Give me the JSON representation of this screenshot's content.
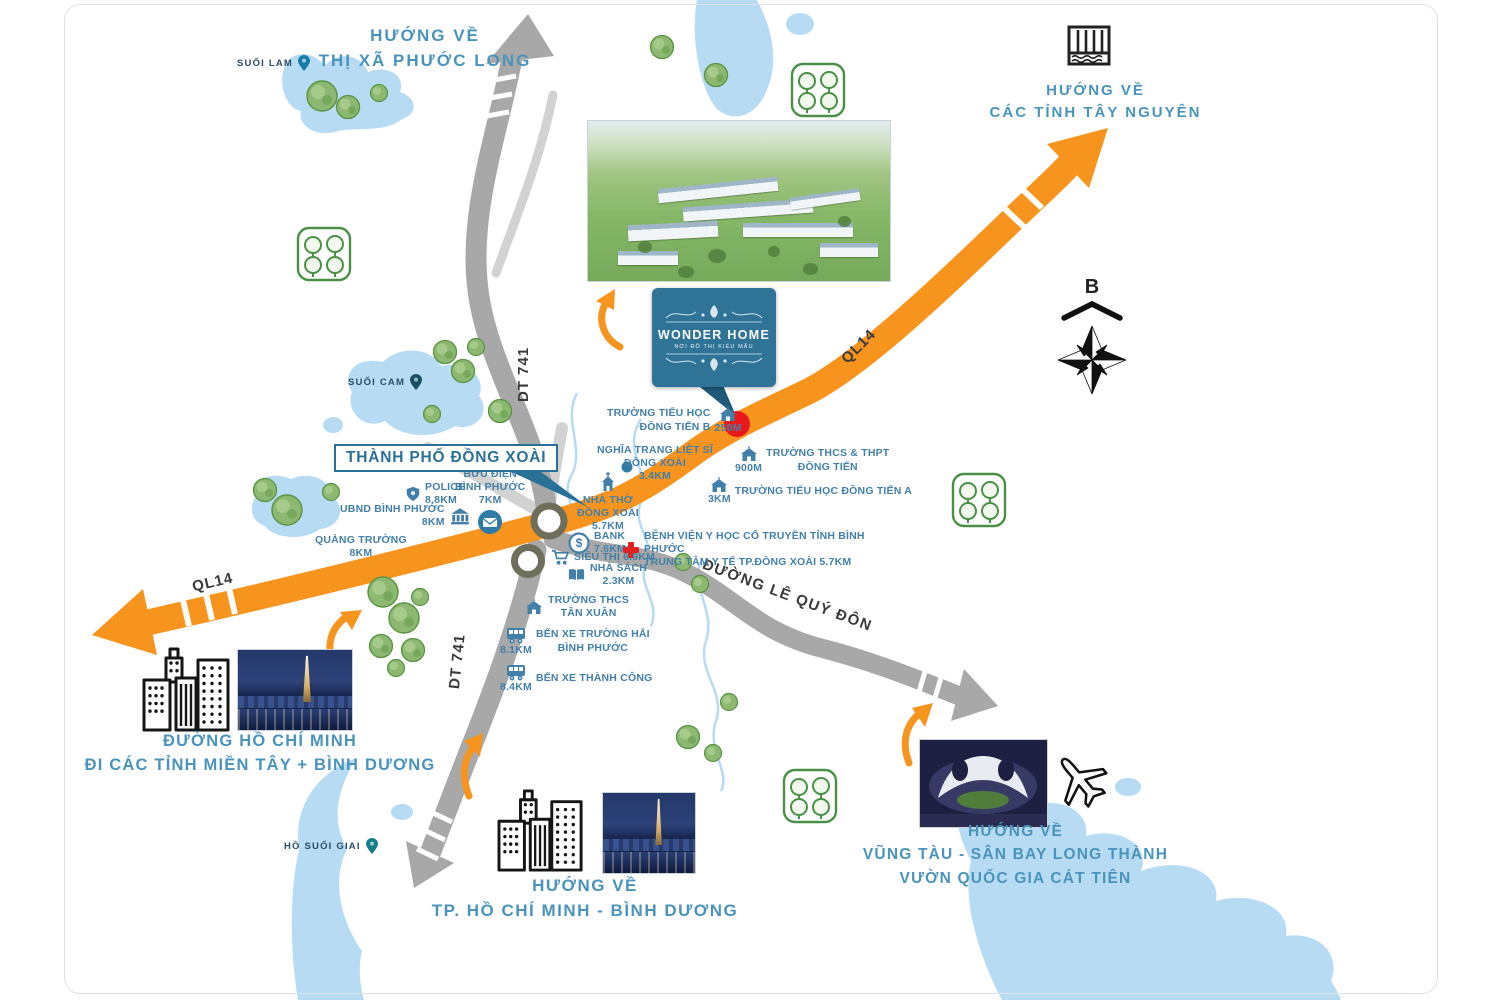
{
  "page": {
    "background": "#ffffff",
    "frame_border": "#dde3e8"
  },
  "project": {
    "name": "WONDER HOME",
    "tagline": "NƠI ĐÔ THỊ KIỂU MẪU",
    "sign_color": "#2f7396",
    "marker_color": "#e8191c"
  },
  "city": {
    "label": "THÀNH PHỐ ĐỒNG XOÀI",
    "box_color": "#2a7197"
  },
  "compass": {
    "north_label": "B"
  },
  "directions": {
    "phuoc_long": "HƯỚNG VỀ\nTHỊ XÃ PHƯỚC LONG",
    "tay_nguyen": "HƯỚNG VỀ\nCÁC TỈNH TÂY NGUYÊN",
    "mien_tay": "ĐƯỜNG HỒ CHÍ MINH\nĐI CÁC TỈNH MIỀN TÂY + BÌNH DƯƠNG",
    "hcm_binh_duong": "HƯỚNG VỀ\nTP. HỒ CHÍ MINH - BÌNH DƯƠNG",
    "vung_tau": "HƯỚNG VỀ\nVŨNG TÀU - SÂN BAY LONG THÀNH\nVƯỜN QUỐC GIA CÁT TIÊN"
  },
  "roads": {
    "ql14_ne": "QL14",
    "ql14_sw": "QL14",
    "dt741_n": "DT 741",
    "dt741_s": "DT 741",
    "le_quy_don": "ĐƯỜNG LÊ QUÝ ĐÔN",
    "highway_color": "#f7941e",
    "road_color": "#a8a8a8"
  },
  "waters": {
    "suoi_lam": "SUỐI LAM",
    "suoi_cam": "SUỐI CAM",
    "ho_suoi_giai": "HỒ SUỐI GIAI",
    "water_color": "#b7dbf3"
  },
  "pois": {
    "police": {
      "name": "POLICE",
      "distance": "8.8KM"
    },
    "post_office": {
      "name": "BƯU ĐIỆN\nBÌNH PHƯỚC",
      "distance": "7KM"
    },
    "ubnd": {
      "name": "UBND BÌNH PHƯỚC",
      "distance": "8KM"
    },
    "square": {
      "name": "QUẢNG TRƯỜNG",
      "distance": "8KM"
    },
    "school_dong_tien_b": {
      "name": "TRƯỜNG TIỂU HỌC\nĐỒNG TIẾN B",
      "distance": "250M"
    },
    "cemetery": {
      "name": "NGHĨA TRANG LIỆT SĨ\nĐỒNG XOÀI",
      "distance": "3.4KM"
    },
    "church": {
      "name": "NHÀ THỜ\nĐỒNG XOÀI",
      "distance": "5.7KM"
    },
    "school_thcs_thpt": {
      "name": "TRƯỜNG THCS & THPT\nĐỒNG TIẾN",
      "distance": "900M"
    },
    "school_dong_tien_a": {
      "name": "TRƯỜNG TIỂU HỌC ĐỒNG TIẾN A",
      "distance": "3KM"
    },
    "bank": {
      "name": "BANK",
      "distance": "7.6KM"
    },
    "hospital": {
      "name": "BỆNH VIỆN Y HỌC CỔ TRUYỀN TỈNH BÌNH PHƯỚC\nTRUNG TÂM Y TẾ TP.ĐỒNG XOÀI",
      "distance": "5.7KM"
    },
    "supermarket": {
      "name": "SIÊU THỊ",
      "distance": "6.9KM"
    },
    "bookstore": {
      "name": "NHÀ SÁCH",
      "distance": "2.3KM"
    },
    "school_tan_xuan": {
      "name": "TRƯỜNG THCS\nTÂN XUÂN",
      "distance": ""
    },
    "bus_truong_hai": {
      "name": "BẾN XE TRƯỜNG HẢI\nBÌNH PHƯỚC",
      "distance": "8.1KM"
    },
    "bus_thanh_cong": {
      "name": "BẾN XE THÀNH CÔNG",
      "distance": "8.4KM"
    }
  },
  "icons": {
    "airplane": "airplane-icon",
    "compass_rose": "compass-rose-icon",
    "sluice_gate": "sluice-gate-icon",
    "city_buildings": "city-buildings-icon",
    "map_pin": "map-pin-icon"
  }
}
